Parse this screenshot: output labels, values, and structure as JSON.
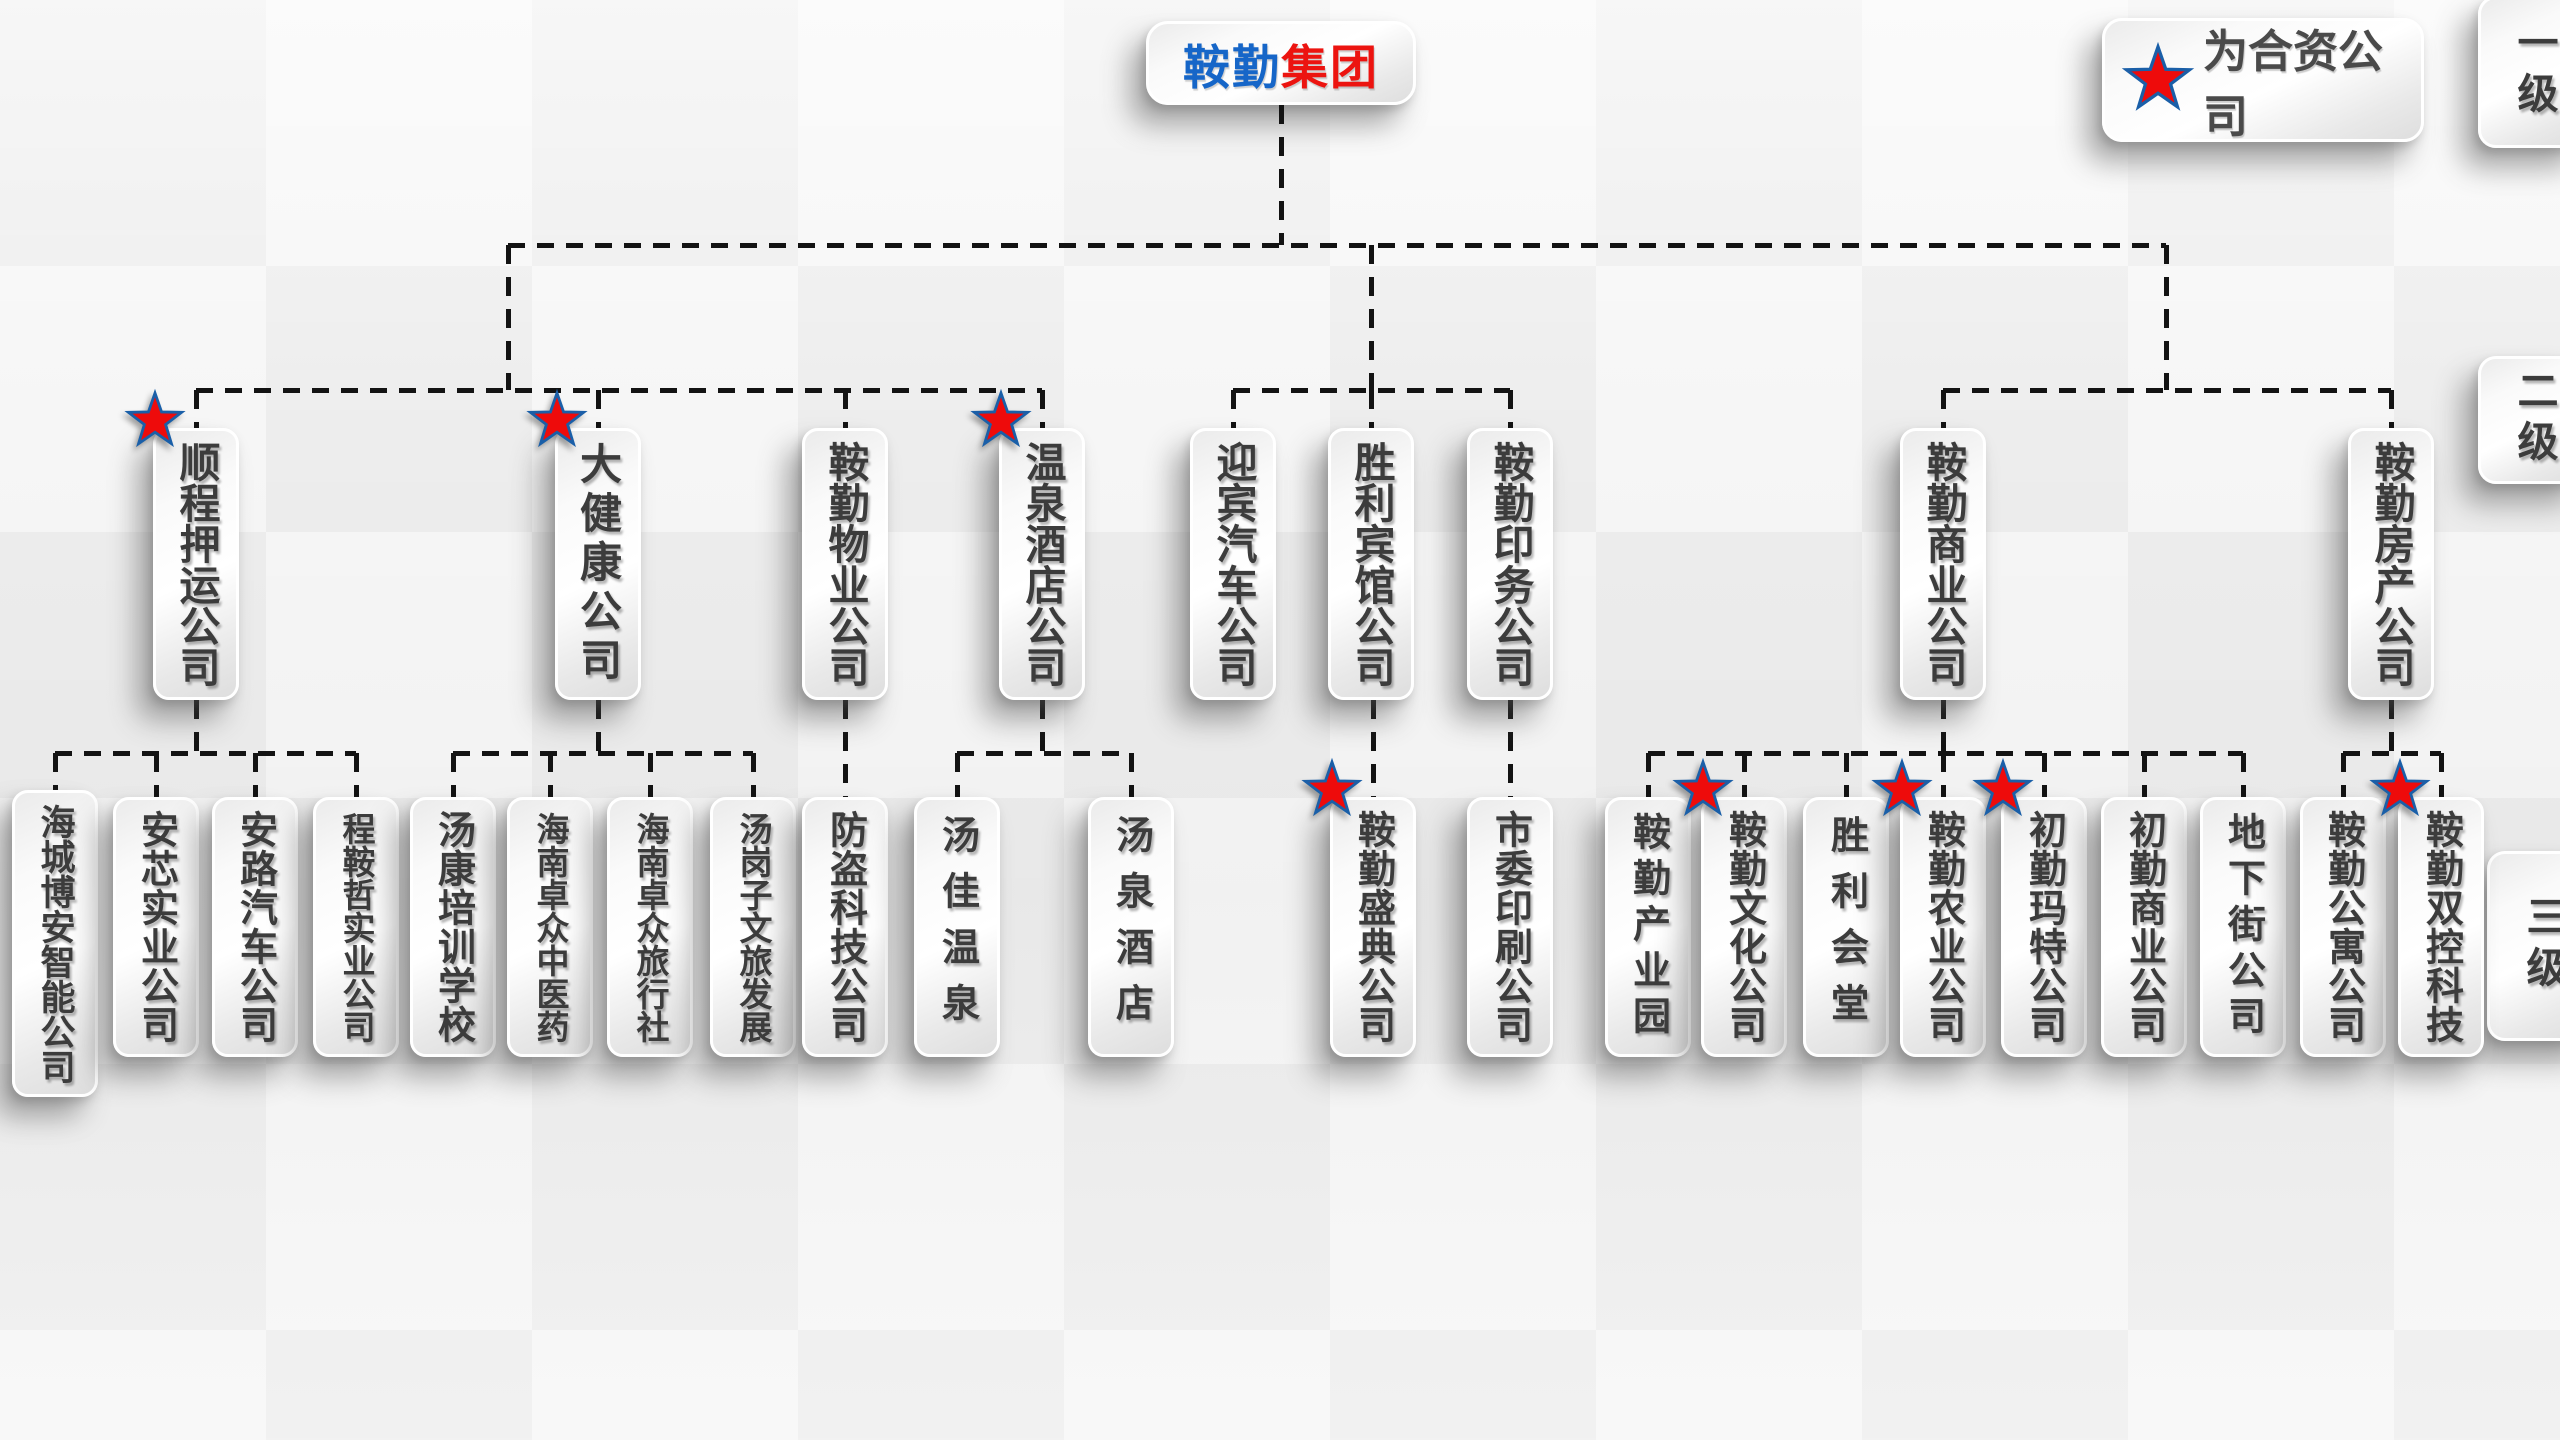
{
  "root": {
    "name_blue": "鞍勤",
    "name_red": "集团"
  },
  "legend": {
    "star_meaning": "为合资公司"
  },
  "level_labels": [
    "一级",
    "二级",
    "三级"
  ],
  "colors": {
    "root_blue": "#1666C8",
    "root_red": "#EC1410",
    "star_fill": "#EE0B0B",
    "star_border": "#1A5FA8",
    "node_text": "#3C3C3C",
    "connector": "#131313"
  },
  "org": {
    "branches": [
      {
        "label": "顺程押运公司",
        "joint_venture": true,
        "children": [
          {
            "label": "海城博安智能公司",
            "joint_venture": false
          },
          {
            "label": "安芯实业公司",
            "joint_venture": false
          },
          {
            "label": "安路汽车公司",
            "joint_venture": false
          },
          {
            "label": "程鞍哲实业公司",
            "joint_venture": false
          }
        ]
      },
      {
        "label": "大健康公司",
        "joint_venture": true,
        "children": [
          {
            "label": "汤康培训学校",
            "joint_venture": false
          },
          {
            "label": "海南卓众中医药",
            "joint_venture": false
          },
          {
            "label": "海南卓众旅行社",
            "joint_venture": false
          },
          {
            "label": "汤岗子文旅发展",
            "joint_venture": false
          }
        ]
      },
      {
        "label": "鞍勤物业公司",
        "joint_venture": false,
        "children": [
          {
            "label": "防盗科技公司",
            "joint_venture": false
          }
        ]
      },
      {
        "label": "温泉酒店公司",
        "joint_venture": true,
        "children": [
          {
            "label": "汤佳温泉",
            "joint_venture": false
          },
          {
            "label": "汤泉酒店",
            "joint_venture": false
          }
        ]
      },
      {
        "label": "迎宾汽车公司",
        "joint_venture": false,
        "children": []
      },
      {
        "label": "胜利宾馆公司",
        "joint_venture": false,
        "children": [
          {
            "label": "鞍勤盛典公司",
            "joint_venture": true
          }
        ]
      },
      {
        "label": "鞍勤印务公司",
        "joint_venture": false,
        "children": [
          {
            "label": "市委印刷公司",
            "joint_venture": false
          }
        ]
      },
      {
        "label": "鞍勤商业公司",
        "joint_venture": false,
        "children": [
          {
            "label": "鞍勤产业园",
            "joint_venture": false
          },
          {
            "label": "鞍勤文化公司",
            "joint_venture": true
          },
          {
            "label": "胜利会堂",
            "joint_venture": false
          },
          {
            "label": "鞍勤农业公司",
            "joint_venture": true
          },
          {
            "label": "初勤玛特公司",
            "joint_venture": true
          },
          {
            "label": "初勤商业公司",
            "joint_venture": false
          },
          {
            "label": "地下街公司",
            "joint_venture": false
          }
        ]
      },
      {
        "label": "鞍勤房产公司",
        "joint_venture": false,
        "children": [
          {
            "label": "鞍勤公寓公司",
            "joint_venture": false
          },
          {
            "label": "鞍勤双控科技",
            "joint_venture": true
          }
        ]
      }
    ]
  }
}
